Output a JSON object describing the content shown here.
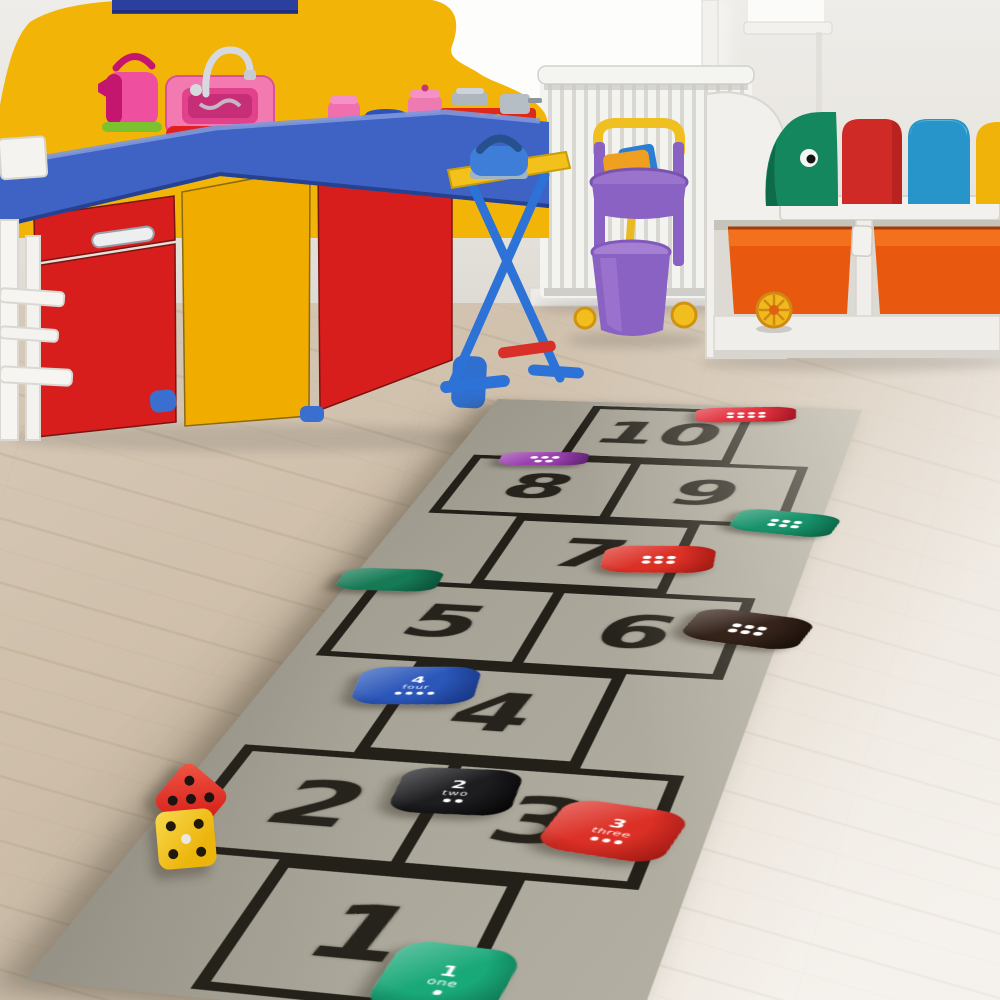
{
  "rug": {
    "surface_color": "#a7a397",
    "line_color": "#232019",
    "size": {
      "w": 360,
      "h": 1070
    },
    "quad": {
      "tl": [
        498,
        399
      ],
      "tr": [
        862,
        410
      ],
      "br": [
        632,
        1042
      ],
      "bl": [
        25,
        980
      ]
    },
    "rows": [
      {
        "cells": [
          "10"
        ]
      },
      {
        "cells": [
          "8",
          "9"
        ]
      },
      {
        "cells": [
          "7"
        ]
      },
      {
        "cells": [
          "5",
          "6"
        ]
      },
      {
        "cells": [
          "4"
        ]
      },
      {
        "cells": [
          "2",
          "3"
        ]
      },
      {
        "cells": [
          "1"
        ]
      }
    ],
    "beanbags": [
      {
        "name": "beanbag-ten-red",
        "color": "#e23340",
        "dark": "#9c121e",
        "style": "dots",
        "dots": 8,
        "x": 252,
        "y": 24,
        "w": 96,
        "h": 44,
        "rot": -8
      },
      {
        "name": "beanbag-eight-purple",
        "color": "#9a3fae",
        "dark": "#571f68",
        "style": "dots",
        "dots": 5,
        "x": 88,
        "y": 166,
        "w": 82,
        "h": 36,
        "rot": -6
      },
      {
        "name": "beanbag-nine-green",
        "color": "#17926a",
        "dark": "#0a5a3e",
        "style": "dots",
        "dots": 6,
        "x": 330,
        "y": 300,
        "w": 88,
        "h": 52,
        "rot": 8
      },
      {
        "name": "beanbag-seven-red",
        "color": "#dc3026",
        "dark": "#951510",
        "style": "dots",
        "dots": 6,
        "x": 240,
        "y": 392,
        "w": 92,
        "h": 58,
        "rot": -6
      },
      {
        "name": "beanbag-five-green",
        "color": "#157a55",
        "dark": "#0a4a33",
        "style": "plain",
        "dots": 0,
        "x": 32,
        "y": 462,
        "w": 84,
        "h": 46,
        "rot": -3
      },
      {
        "name": "beanbag-six-black",
        "color": "#35231a",
        "dark": "#140b06",
        "style": "dots",
        "dots": 6,
        "x": 334,
        "y": 520,
        "w": 92,
        "h": 60,
        "rot": 10
      },
      {
        "name": "beanbag-four-blue",
        "label": "4",
        "word": "four",
        "color": "#2b57ba",
        "dark": "#142f78",
        "style": "text",
        "dots": 4,
        "x": 112,
        "y": 652,
        "w": 90,
        "h": 64,
        "rot": -8
      },
      {
        "name": "beanbag-two-black",
        "label": "2",
        "word": "two",
        "color": "#1d1d20",
        "dark": "#000000",
        "style": "text",
        "dots": 2,
        "x": 186,
        "y": 806,
        "w": 82,
        "h": 64,
        "rot": -4
      },
      {
        "name": "beanbag-three-red",
        "label": "3",
        "word": "three",
        "color": "#dc3026",
        "dark": "#951510",
        "style": "text",
        "dots": 3,
        "x": 300,
        "y": 842,
        "w": 84,
        "h": 68,
        "rot": 8
      },
      {
        "name": "beanbag-one-green",
        "label": "1",
        "word": "one",
        "color": "#19a878",
        "dark": "#0b5f43",
        "style": "text",
        "dots": 1,
        "x": 242,
        "y": 1028,
        "w": 74,
        "h": 74,
        "rot": 3
      }
    ]
  },
  "dice": [
    {
      "name": "red-die",
      "color": "#d8231d",
      "light": "#f05846",
      "pips": 5,
      "pip_color": "#1c1410",
      "center_pip": "#1c1410",
      "x": 191,
      "y": 799,
      "size": 56,
      "rot": 40
    },
    {
      "name": "yellow-die",
      "color": "#ecb50c",
      "light": "#f9d94e",
      "pips": 5,
      "pip_color": "#201809",
      "center_pip": "#e9e7e0",
      "x": 186,
      "y": 839,
      "size": 58,
      "rot": -5
    }
  ],
  "room": {
    "wall_color": "#e9e6e1",
    "floor_color": "#d2c3b0",
    "kitchen": {
      "backsplash": "#f3b408",
      "counter": "#3f63c4",
      "door_red": "#d81d1d",
      "door_yellow": "#f0ad00",
      "kettle_pink": "#ee4f9e",
      "sink_pink": "#f27ab0",
      "basin_red": "#e02020",
      "shelf_blue": "#2b3f9e"
    },
    "radiator_color": "#f3f3f0",
    "ironing_board": {
      "board_yellow": "#f2c11c",
      "leg_blue": "#2d72d6",
      "iron_blue": "#3f7ed8"
    },
    "trolley": {
      "purple": "#8a62c4",
      "yellow": "#f0c020",
      "pan_blue": "#2a7fd4",
      "broom_orange": "#f0a020"
    },
    "bench": {
      "white": "#f1f0ec",
      "bin_orange": "#e8590f",
      "bin_rim": "#f3701c",
      "cushions": [
        "#15875f",
        "#d02a26",
        "#2794ca",
        "#f0b30a"
      ]
    }
  }
}
